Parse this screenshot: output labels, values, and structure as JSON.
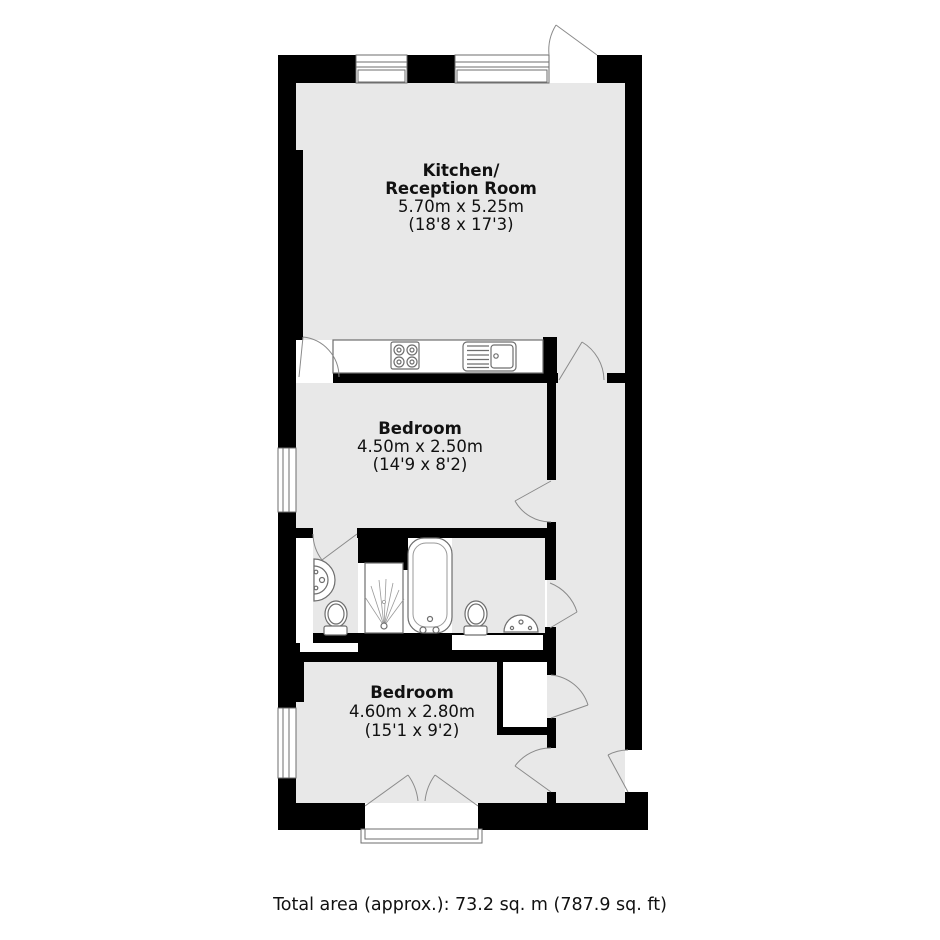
{
  "page": {
    "background": "#ffffff"
  },
  "plan": {
    "colors": {
      "wall": "#000000",
      "floor": "#e8e8e8",
      "opening": "#ffffff",
      "fixture_outline": "#6e6e6e",
      "detail_outline": "#999999",
      "arc": "#8a8a8a",
      "text": "#111111"
    },
    "rooms": [
      {
        "id": "kitchen-reception-room",
        "name_line1": "Kitchen/",
        "name_line2": "Reception Room",
        "dims_metric": "5.70m x 5.25m",
        "dims_imperial": "(18'8 x 17'3)"
      },
      {
        "id": "bedroom-1",
        "name": "Bedroom",
        "dims_metric": "4.50m x 2.50m",
        "dims_imperial": "(14'9 x 8'2)"
      },
      {
        "id": "bedroom-2",
        "name": "Bedroom",
        "dims_metric": "4.60m x 2.80m",
        "dims_imperial": "(15'1 x 9'2)"
      }
    ],
    "fixtures": [
      "kitchen-counter",
      "hob",
      "sink-with-drainer",
      "wall-basin",
      "toilet",
      "shower",
      "bathtub",
      "toilet",
      "basin"
    ],
    "features": [
      "top-windows",
      "side-windows",
      "door-swings",
      "entrance-door",
      "french-doors",
      "balcony-step",
      "closet",
      "hallway"
    ]
  },
  "footer": {
    "total_area": "Total area (approx.): 73.2 sq. m (787.9 sq. ft)"
  }
}
